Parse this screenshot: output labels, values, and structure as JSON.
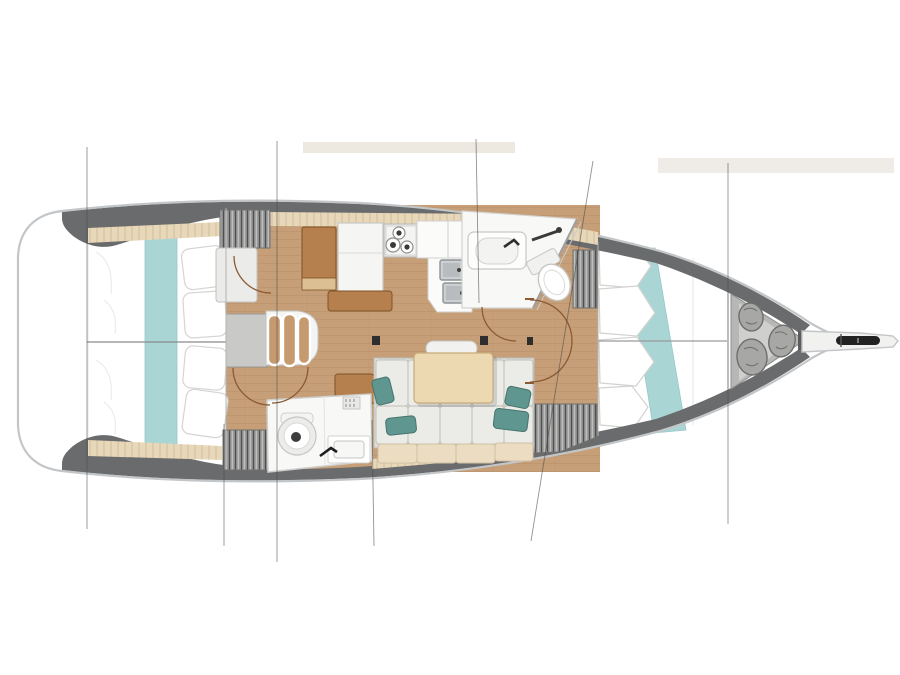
{
  "diagram": {
    "type": "yacht-interior-floor-plan",
    "orientation": "bow-right",
    "counts": {
      "aft_cabins": 2,
      "heads": 2,
      "companionway_steps": 3,
      "stove_burners": 3,
      "galley_sinks": 2,
      "bow_storage_bags": 3,
      "forward_bed_pillows": 4,
      "aft_bed_pillows_each": 2,
      "hull_section_lines": 7,
      "wardrobes": 4,
      "mast_steps": 2
    },
    "areas": [
      {
        "id": "aft-cabin-port",
        "desc": "aft double cabin, top-left"
      },
      {
        "id": "aft-cabin-starboard",
        "desc": "aft double cabin, bottom-left"
      },
      {
        "id": "companionway",
        "desc": "entry steps, center-left"
      },
      {
        "id": "galley",
        "desc": "stove, double sink, counters, top-center"
      },
      {
        "id": "nav-station",
        "desc": "chart table and seat"
      },
      {
        "id": "aft-head",
        "desc": "toilet and washbasin, bottom-center"
      },
      {
        "id": "saloon",
        "desc": "dining table, bench and L-sofa with pillows"
      },
      {
        "id": "forward-head",
        "desc": "en-suite with vanity, shower and toilet"
      },
      {
        "id": "forward-cabin",
        "desc": "V-berth with runner and pillows"
      },
      {
        "id": "bow-locker",
        "desc": "sail locker with three storage bags"
      },
      {
        "id": "bowsprit",
        "desc": "bow fitting with anchor roller"
      }
    ]
  },
  "colors": {
    "hull_line": "#c3c6c8",
    "band": "#6a6b6d",
    "floor": "#c69f78",
    "floor_line": "#b28a63",
    "wood": "#b5804e",
    "wood_border": "#7f5226",
    "wood_light": "#dcc094",
    "wood_step": "#c59a6f",
    "table": "#ecd9b1",
    "table_border": "#c9ab79",
    "beige": "#e8d8ba",
    "beige_line": "#c7b28e",
    "teal": "#a9d5d5",
    "teal_line": "#8cc0c0",
    "pillow_teal": "#5f968f",
    "pillow_teal_dark": "#47746e",
    "cushion": "#ebebe7",
    "cushion_line": "#bfbfb9",
    "cushion_beige": "#ecdcc1",
    "head_floor": "#f8f8f7",
    "fixture_line": "#c9c9c7",
    "steel": "#cdd0d2",
    "steel_dark": "#8f9395",
    "locker": "#9b9b9b",
    "locker_line": "#4f4f4d",
    "locker_tri": "#b7b7b5",
    "locker_tri_in": "#cfcfcd",
    "bag": "#a7a7a5",
    "bag_line": "#6e6e6c",
    "arc": "#8a5a34",
    "section": "#4a4a4a",
    "dark": "#2e2e2e",
    "white": "#ffffff",
    "bulkhead": "#b3b3b1"
  }
}
